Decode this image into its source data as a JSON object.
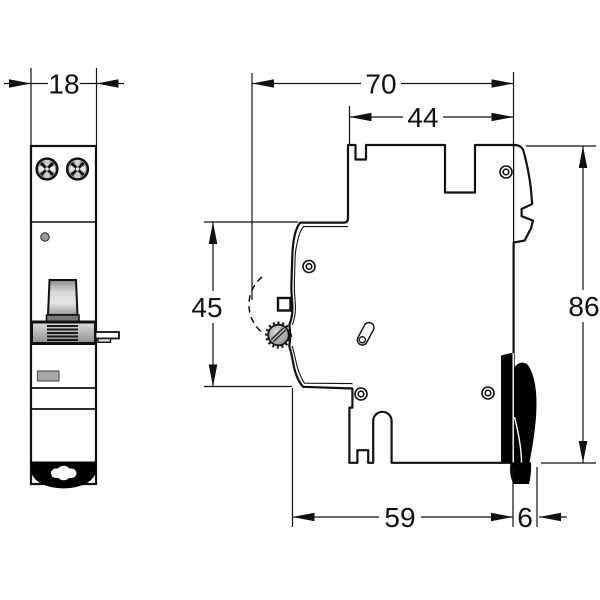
{
  "drawing": {
    "type": "technical-dimension-drawing",
    "views": {
      "front": "front view",
      "side": "side view"
    },
    "dimensions": {
      "front_width": "18",
      "overall_depth": "70",
      "upper_body_depth": "44",
      "handle_zone_height": "45",
      "overall_height": "86",
      "lower_body_depth": "59",
      "din_clip_depth": "6"
    },
    "colors": {
      "line": "#111111",
      "background": "#ffffff",
      "metal_gray": "#9f9f9f",
      "clip_black": "#000000"
    }
  }
}
